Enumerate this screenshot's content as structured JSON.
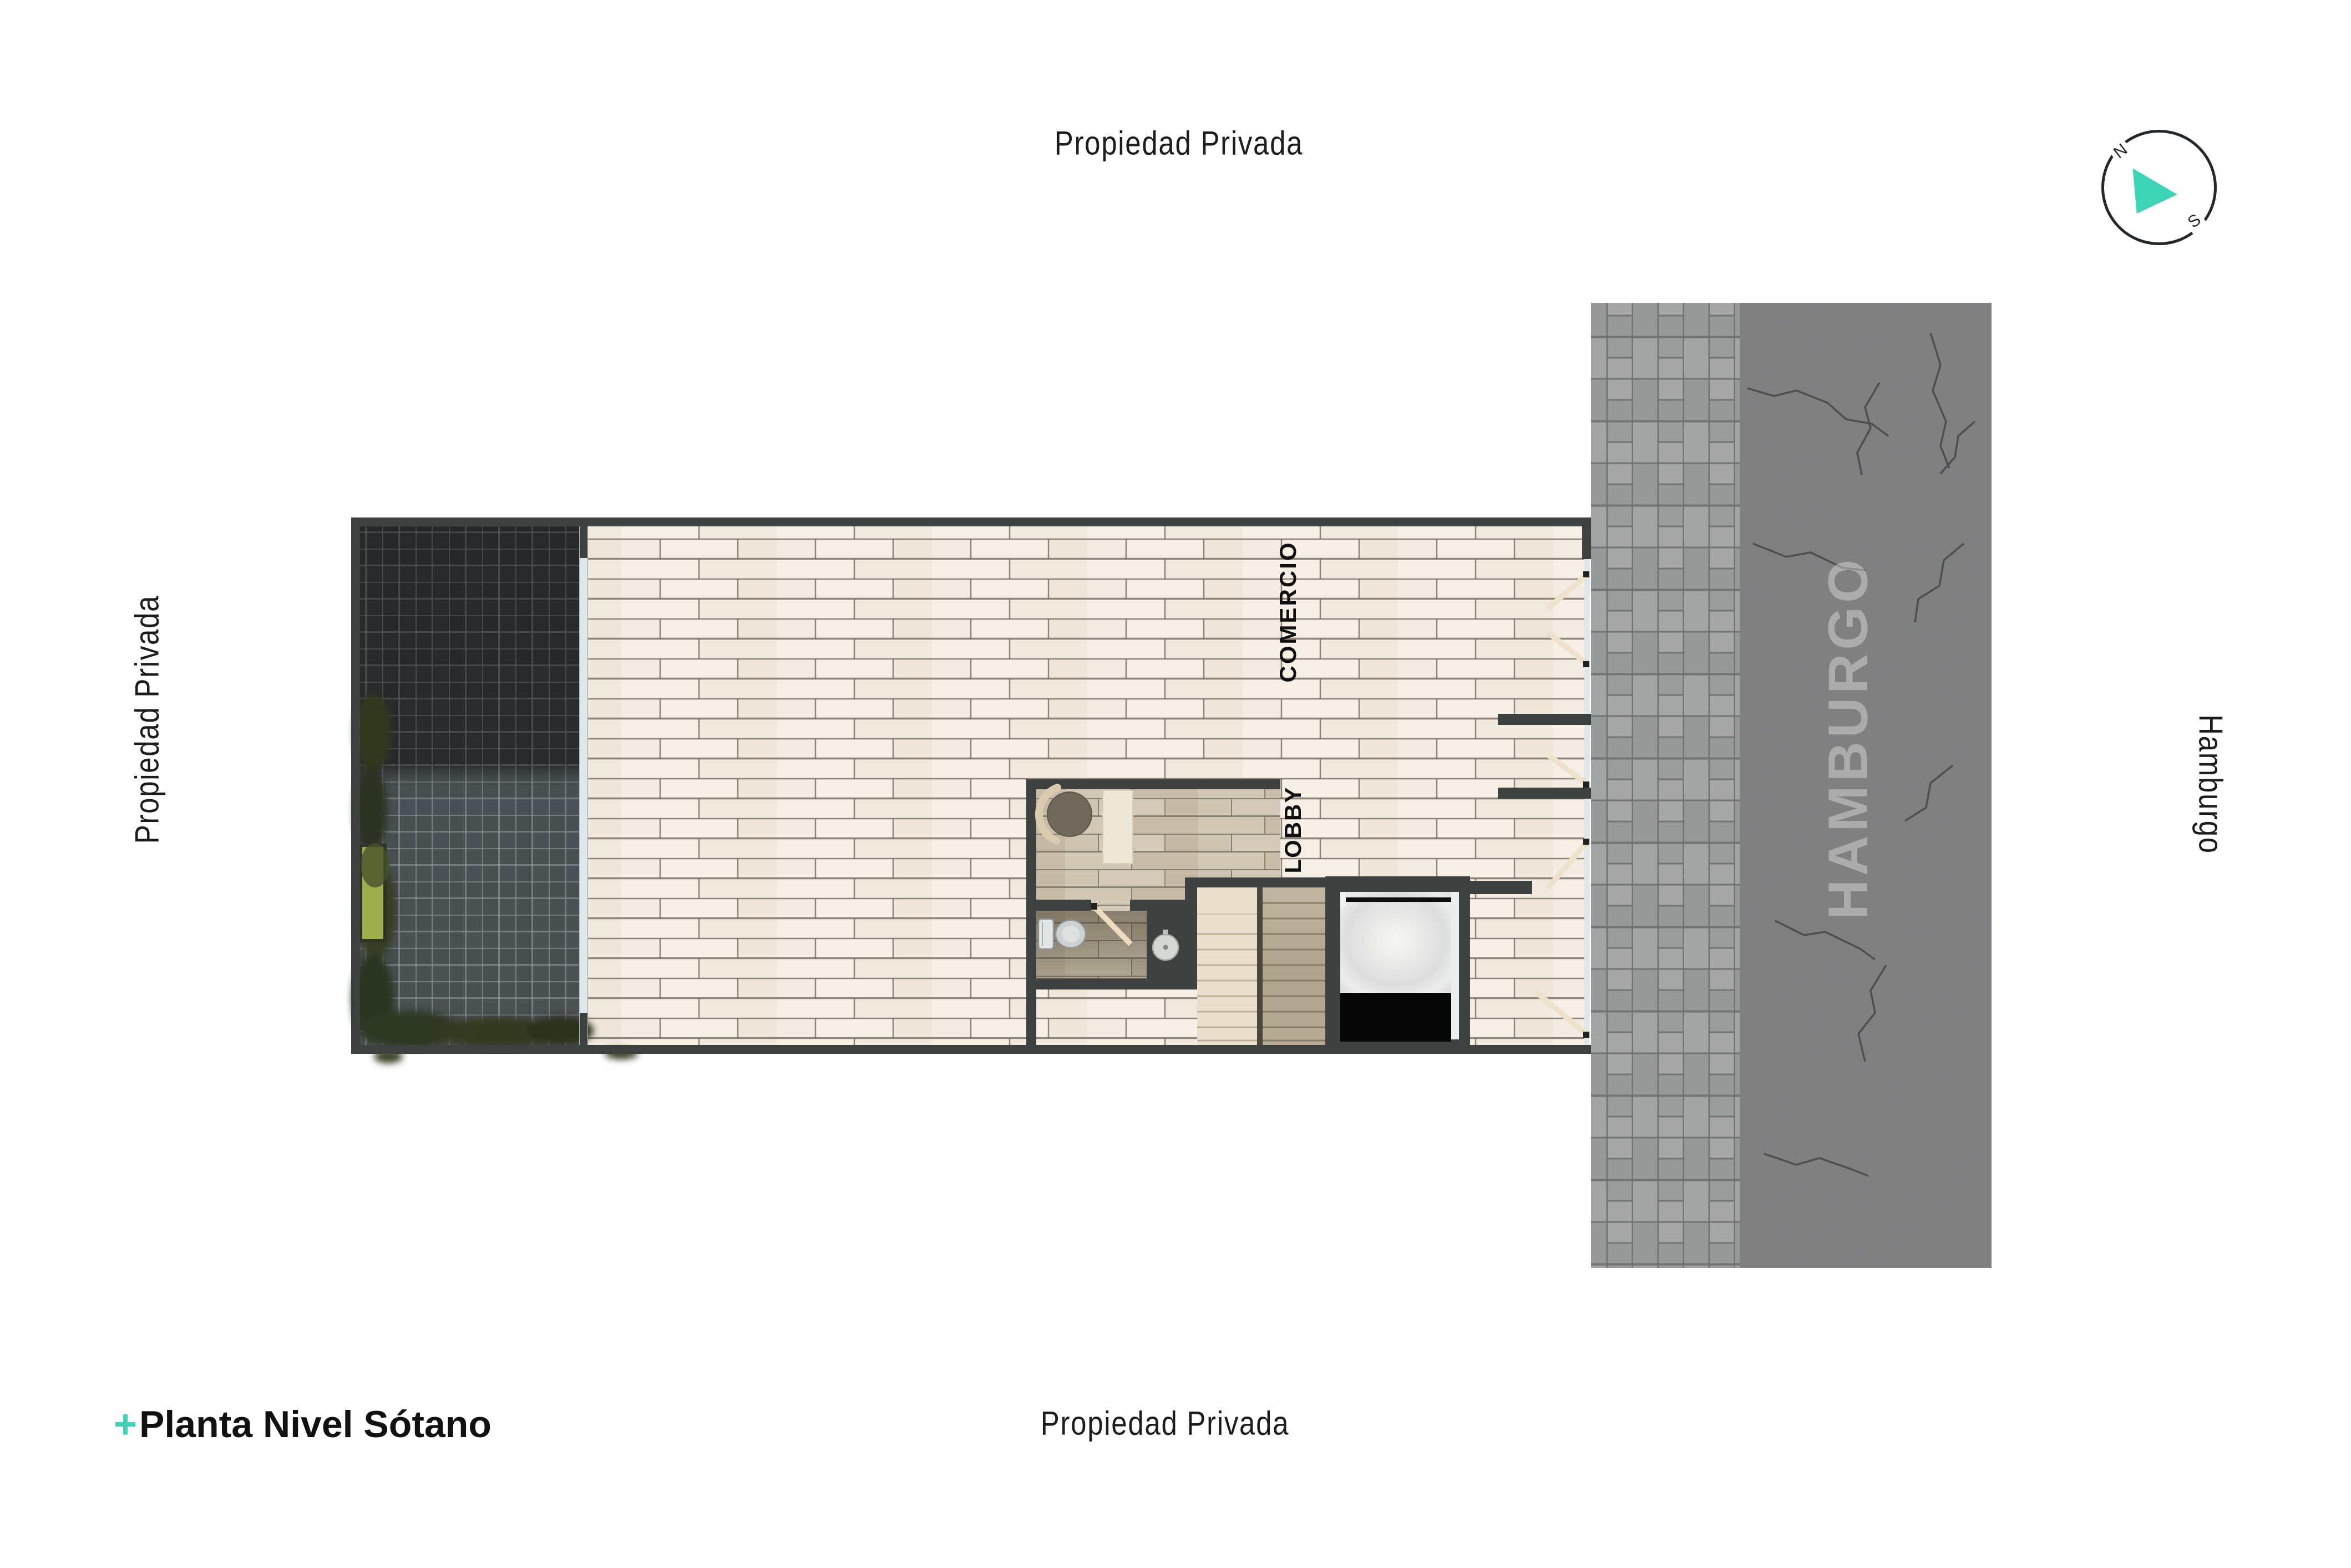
{
  "surroundings": {
    "top_label": "Propiedad Privada",
    "left_label": "Propiedad Privada",
    "bottom_label": "Propiedad Privada",
    "right_label": "Hamburgo",
    "street_pavement_text": "HAMBURGO"
  },
  "title": {
    "bullet": "+",
    "text": "Planta Nivel Sótano"
  },
  "compass": {
    "north": "N",
    "south": "S"
  },
  "rooms": {
    "comercio": "COMERCIO",
    "lobby": "LOBBY"
  },
  "colors": {
    "accent_teal": "#3bd4b4",
    "wall_dark": "#3d4140",
    "floor_cream": "#f2ebe0",
    "floor_lobby_tan": "#cfc4b2",
    "courtyard_tile": "#3c4144",
    "sidewalk_paver": "#9d9f9e",
    "street_asphalt": "#7e7f80",
    "elevator_cab_black": "#070707",
    "travertine_light": "#eadfcc",
    "travertine_dark": "#c8baa2"
  }
}
